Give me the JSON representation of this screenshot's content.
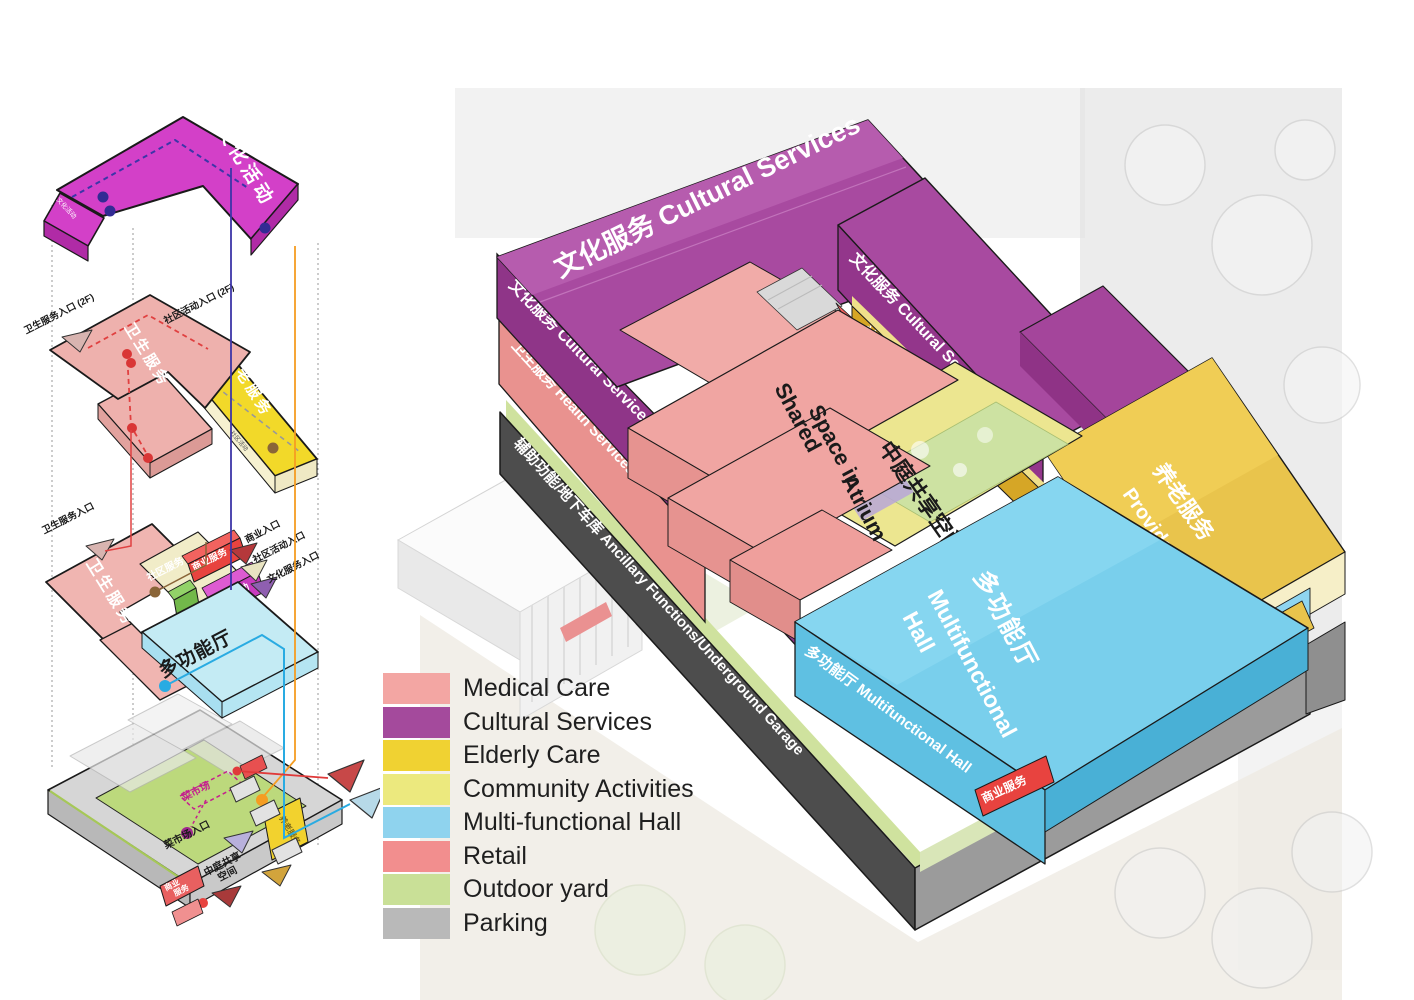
{
  "legend": {
    "items": [
      {
        "label": "Medical Care",
        "color": "#f3a6a3"
      },
      {
        "label": "Cultural Services",
        "color": "#a44a9c"
      },
      {
        "label": "Elderly Care",
        "color": "#f0d232"
      },
      {
        "label": "Community Activities",
        "color": "#ece97e"
      },
      {
        "label": "Multi-functional Hall",
        "color": "#8fd3ee"
      },
      {
        "label": "Retail",
        "color": "#f28e8e"
      },
      {
        "label": "Outdoor yard",
        "color": "#c9e097"
      },
      {
        "label": "Parking",
        "color": "#b9b9b9"
      }
    ]
  },
  "right": {
    "cultural_top": "文化服务 Cultural Services",
    "cultural_left": "文化服务 Cultural Services",
    "cultural_right": "文化服务 Cultural Services",
    "health_left": "卫生服务 Health Services",
    "ancillary": "辅助功能/地下车库 Ancillary Functions/Underground Garage",
    "community": "社区活动 Community Activities",
    "retail_upper": "商业服务",
    "retail_lower": "商业服务",
    "elderly_cn": "养老服务",
    "elderly_en1": "Provide for",
    "elderly_en2": "the Aged Services",
    "elderly_tag": "养老服务",
    "atrium_cn": "中庭共享空间",
    "atrium_en1": "Shared",
    "atrium_en2": "Space in",
    "atrium_en3": "Atrium",
    "hall_cn": "多功能厅",
    "hall_en1": "Multifunctional",
    "hall_en2": "Hall",
    "hall_left": "多功能厅 Multifunctional Hall"
  },
  "left": {
    "cultural_top": "文化活动",
    "cultural_side": "文化活动",
    "health2f_top": "卫生服务",
    "health2f_side": "卫生服务  卫生服务",
    "elderly_top": "养老服务",
    "elderly_side1": "社区活动",
    "elderly_side2": "社区活动",
    "entrance_health_2f": "卫生服务入口 (2F)",
    "entrance_community_2f": "社区活动入口 (2F)",
    "entrance_health": "卫生服务入口",
    "entrance_retail": "商业入口",
    "entrance_community": "社区活动入口",
    "entrance_cultural": "文化服务入口",
    "ground_health": "卫生服务",
    "ground_community": "社区服务",
    "ground_retail": "商业服务",
    "ground_cultural": "文化活动",
    "ground_hall": "多功能厅",
    "base_market": "菜市场",
    "base_market_entrance": "菜市场入口",
    "base_atrium1": "中庭共享",
    "base_atrium2": "空间",
    "base_retail1": "商业",
    "base_retail2": "服务",
    "base_elderly": "养老服务"
  }
}
